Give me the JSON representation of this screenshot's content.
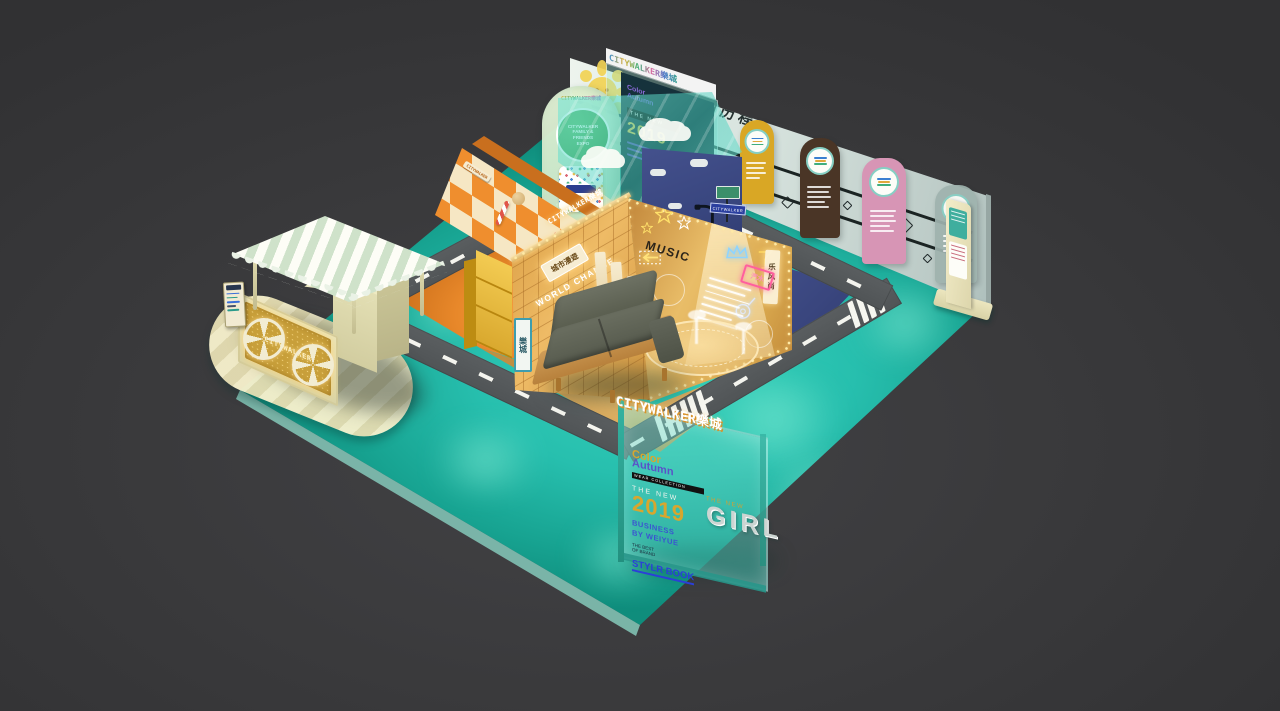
{
  "scene": {
    "title": "CITYWALKER 樂城 exhibition booth 3D render"
  },
  "colors": {
    "floor": "#27bfae",
    "background": "#39393b",
    "gold": "#e8b45c",
    "orange": "#e8872b",
    "navy": "#3c4a85",
    "wall": "#dfe9e4"
  },
  "back_wall": {
    "heading": "公司历程",
    "tag_arrow": "▶",
    "tag_label": "公司历程",
    "panels": [
      {
        "name": "milestone-1",
        "color": "#d9a725"
      },
      {
        "name": "milestone-2",
        "color": "#4a3526"
      },
      {
        "name": "milestone-3",
        "color": "#d795b5"
      },
      {
        "name": "milestone-4",
        "color": "#9fb3ae"
      }
    ]
  },
  "board": {
    "header": "CITYWALKER樂城",
    "color_word": "Color",
    "autumn_word": "Autumn",
    "kicker": "THE NEW",
    "year": "2019"
  },
  "standee": {
    "header": "CITYWALKER樂城",
    "badge_line1": "CITYWALKER",
    "badge_line2": "FAMILY &",
    "badge_line3": "FRIENDS",
    "badge_line4": "EXPO"
  },
  "candy_wall": {
    "sign": "CITYWALKER"
  },
  "grid_wall": {
    "brand": "CITYWALKER樂城",
    "lit_sign": "城市漫遊",
    "glow_text": "WORLD CHANGE",
    "side_sign": "樂城"
  },
  "music_wall": {
    "title": "MUSIC",
    "banner": "乐风尚",
    "neon_sign": "汽水"
  },
  "nav_sign": {
    "label": "CITYWALKER"
  },
  "front_panel": {
    "header": "CITYWALKER樂城",
    "color_word": "Color",
    "autumn_word": "Autumn",
    "collection_bar": "WEAR COLLECTION",
    "kicker": "THE NEW",
    "year": "2019",
    "business_line1": "BUSINESS",
    "business_line2": "BY WEIYUE",
    "best_line1": "THE BEST",
    "best_line2": "OF BRAND",
    "style_book": "STYLR BOOK",
    "girl_kicker": "THE NEW",
    "girl": "GIRL"
  },
  "cart": {
    "sign": "CITYWALKER"
  }
}
